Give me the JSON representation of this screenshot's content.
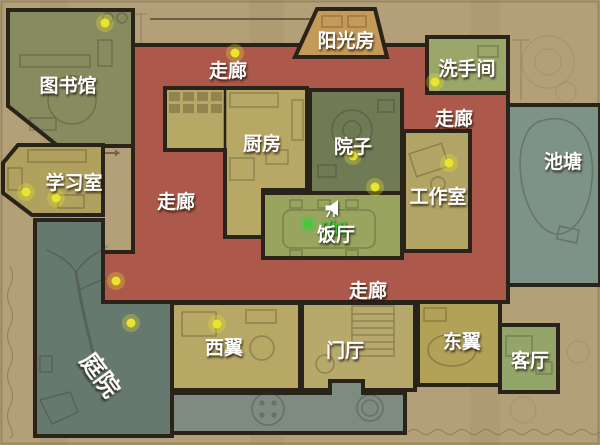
{
  "map": {
    "rooms": {
      "library": "图书馆",
      "study_room": "学习室",
      "corridor": "走廊",
      "sunroom": "阳光房",
      "washroom": "洗手间",
      "kitchen": "厨房",
      "courtyard": "院子",
      "studio": "工作室",
      "dining_room": "饭厅",
      "pond": "池塘",
      "garden": "庭院",
      "west_wing": "西翼",
      "foyer": "门厅",
      "east_wing": "东翼",
      "living_room": "客厅"
    },
    "player": {
      "label": "[你]",
      "color": "#3ecb3b",
      "position": [
        308,
        224
      ]
    },
    "markers": {
      "collectible_color": "#e9e42c",
      "collectibles": [
        [
          105,
          23
        ],
        [
          235,
          53
        ],
        [
          435,
          82
        ],
        [
          26,
          192
        ],
        [
          56,
          198
        ],
        [
          116,
          281
        ],
        [
          131,
          323
        ],
        [
          217,
          324
        ],
        [
          353,
          156
        ],
        [
          375,
          187
        ],
        [
          449,
          163
        ]
      ]
    },
    "icons": {
      "speaker": "megaphone"
    },
    "palette": {
      "paper": "#b3a078",
      "corridor": "#ac584a",
      "library": "#878b60",
      "study": "#b1a15e",
      "sunroom": "#c39a57",
      "washroom": "#9aa66a",
      "kitchen": "#b8a865",
      "courtyard": "#707a55",
      "studio": "#b2a465",
      "dining": "#99a55f",
      "pond": "#7d9288",
      "garden": "#66796f",
      "west_wing": "#b7a866",
      "foyer": "#b7a96c",
      "east_wing": "#b1a257",
      "living": "#93a568",
      "terrace": "#7e8b80",
      "wall": "#2a2319",
      "label_text": "#ffffff"
    }
  }
}
